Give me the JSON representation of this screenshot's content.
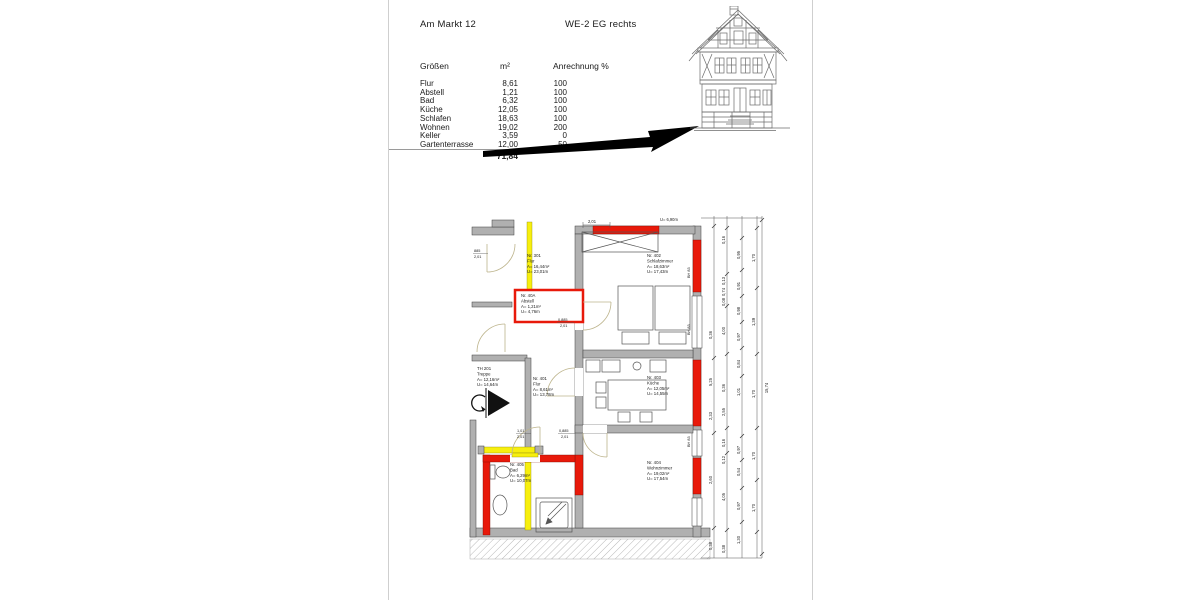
{
  "header": {
    "address": "Am Markt 12",
    "unit": "WE-2 EG rechts"
  },
  "table": {
    "headers": {
      "col1": "Größen",
      "col2": "m²",
      "col3": "Anrechnung %"
    },
    "rows": [
      {
        "label": "Flur",
        "m2": "8,61",
        "pct": "100"
      },
      {
        "label": "Abstell",
        "m2": "1,21",
        "pct": "100"
      },
      {
        "label": "Bad",
        "m2": "6,32",
        "pct": "100"
      },
      {
        "label": "Küche",
        "m2": "12,05",
        "pct": "100"
      },
      {
        "label": "Schlafen",
        "m2": "18,63",
        "pct": "100"
      },
      {
        "label": "Wohnen",
        "m2": "19,02",
        "pct": "200"
      },
      {
        "label": "Keller",
        "m2": "3,59",
        "pct": "0"
      },
      {
        "label": "Gartenterrasse",
        "m2": "12,00",
        "pct": "50"
      }
    ],
    "total": "71,84"
  },
  "plan": {
    "rooms": {
      "r301": {
        "no": "Nr. 301",
        "name": "Flur",
        "area": "A= 16,44m²",
        "per": "U= 23,01m"
      },
      "r40A": {
        "no": "Nr. 40A",
        "name": "Abstell",
        "area": "A= 1,21m²",
        "per": "U= 4,76m"
      },
      "r402": {
        "no": "Nr. 402",
        "name": "Schlafzimmer",
        "area": "A= 18,63m²",
        "per": "U= 17,43m"
      },
      "r401": {
        "no": "Nr. 401",
        "name": "Flur",
        "area": "A=  8,61m²",
        "per": "U= 13,78m"
      },
      "th201": {
        "no": "TH 201",
        "name": "Treppe",
        "area": "A= 12,16m²",
        "per": "U= 14,64m"
      },
      "r403": {
        "no": "Nr. 403",
        "name": "Küche",
        "area": "A= 12,05m²",
        "per": "U= 14,55m"
      },
      "r405": {
        "no": "Nr. 405",
        "name": "Bad",
        "area": "A=  6,29m²",
        "per": "U= 10,07m"
      },
      "r404": {
        "no": "Nr. 404",
        "name": "Wohnzimmer",
        "area": "A= 19,02m²",
        "per": "U= 17,54m"
      }
    },
    "top_dim": "2,01",
    "top_perimeter": "U= 6,90m",
    "window_mark": "BH 83",
    "doors": {
      "d1": [
        "885",
        "2,01"
      ],
      "d2": [
        "0,885",
        "2,01"
      ],
      "d3": [
        "1,01",
        "2,01"
      ],
      "d4": [
        "0,885",
        "2,01"
      ]
    },
    "chains": {
      "a": [
        "0,36",
        "5,25",
        "2,33",
        "2,60",
        "0,38"
      ],
      "b": [
        "0,16",
        "0,13",
        "0,74",
        "0,08",
        "4,00",
        "0,36",
        "2,55",
        "0,16",
        "0,12",
        "4,05",
        "0,38"
      ],
      "c": [
        "0,95",
        "0,91",
        "0,98",
        "0,97",
        "0,84",
        "1,01",
        "0,97",
        "0,54",
        "0,97",
        "1,30"
      ],
      "d": [
        "1,70",
        "1,39",
        "1,70",
        "1,70",
        "1,70"
      ],
      "total": "15,74"
    }
  }
}
